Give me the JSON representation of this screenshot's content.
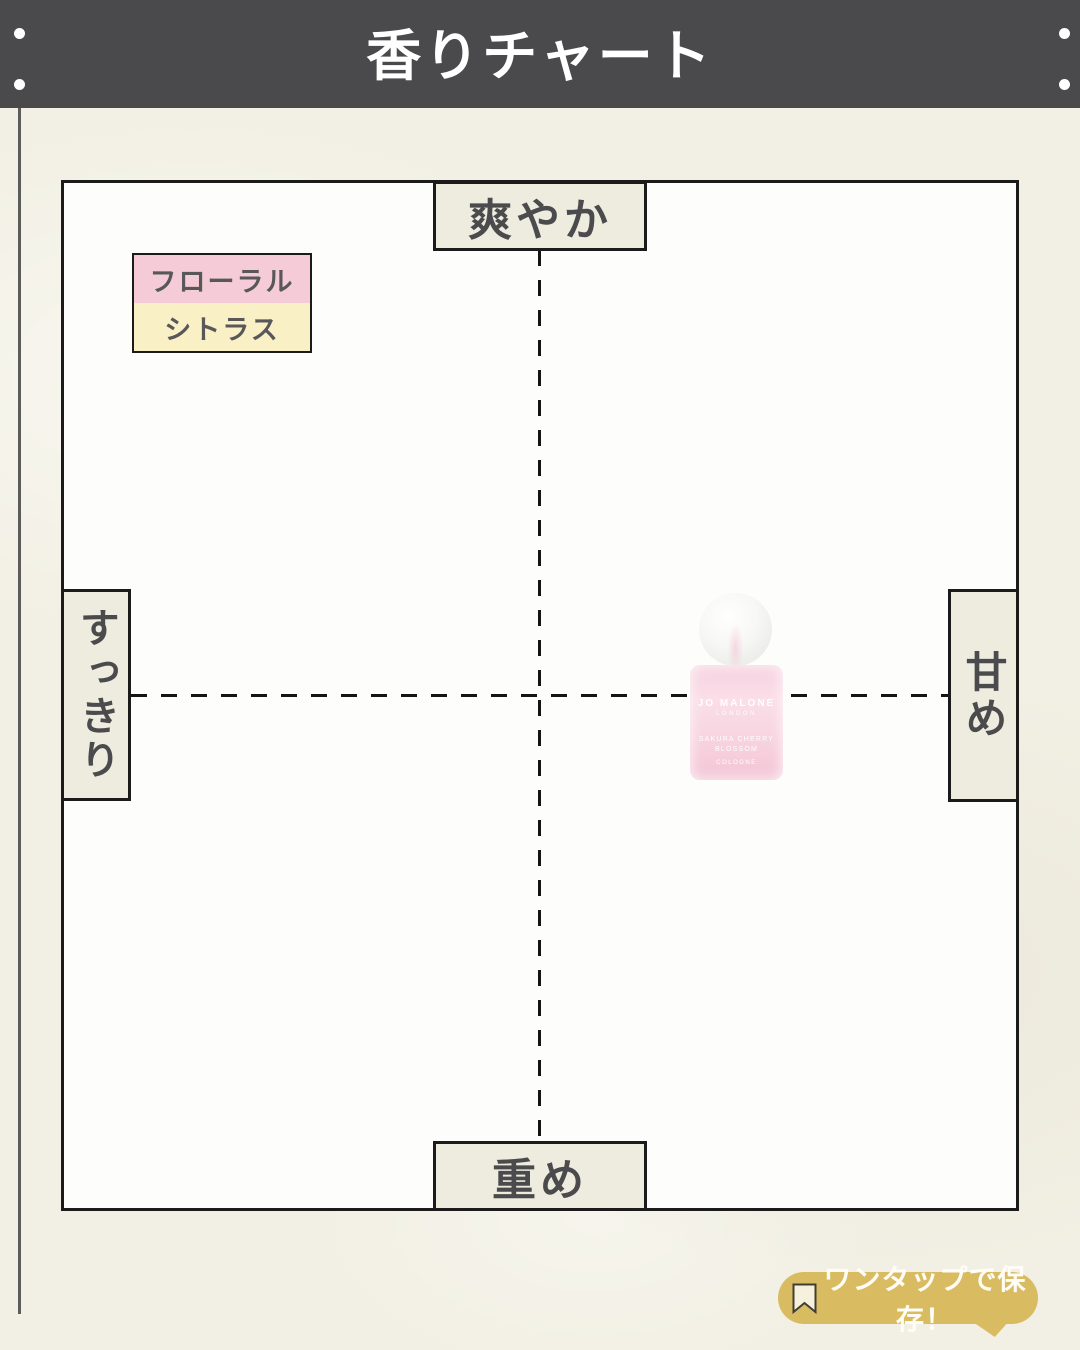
{
  "header": {
    "title": "香りチャート"
  },
  "chart": {
    "axis_labels": {
      "top": "爽やか",
      "bottom": "重め",
      "left": "すっきり",
      "right": "甘め"
    },
    "legend": {
      "items": [
        {
          "label": "フローラル",
          "color": "#f4cbd6"
        },
        {
          "label": "シトラス",
          "color": "#faf0c6"
        }
      ]
    },
    "product": {
      "brand": "JO MALONE",
      "city": "LONDON",
      "name_line1": "SAKURA CHERRY",
      "name_line2": "BLOSSOM",
      "type": "COLOGNE"
    }
  },
  "footer": {
    "save_badge": {
      "label": "ワンタップで保存！",
      "icon": "bookmark-icon",
      "color": "#d9bc62"
    }
  },
  "colors": {
    "header_bg": "#4a4a4c",
    "paper_bg": "#f2f0e4",
    "board_bg": "#fdfdfb",
    "axis_box_bg": "#edecdf",
    "border": "#1b1b1b",
    "label_text": "#4b4b4d",
    "legend_floral": "#f4cbd6",
    "legend_citrus": "#faf0c6",
    "badge_gold": "#d9bc62",
    "bottle_pink": "#f7d2e0"
  },
  "chart_data": {
    "type": "scatter",
    "title": "香りチャート",
    "x_axis": {
      "negative_label": "すっきり",
      "positive_label": "甘め",
      "range": [
        -1,
        1
      ]
    },
    "y_axis": {
      "negative_label": "重め",
      "positive_label": "爽やか",
      "range": [
        -1,
        1
      ]
    },
    "grid": "center dashed cross axes only",
    "legend": {
      "position": "top-left",
      "entries": [
        {
          "label": "フローラル",
          "color": "#f4cbd6"
        },
        {
          "label": "シトラス",
          "color": "#faf0c6"
        }
      ]
    },
    "points": [
      {
        "label": "JO MALONE LONDON SAKURA CHERRY BLOSSOM COLOGNE",
        "x": 0.41,
        "y": 0.0,
        "marker": "pink-perfume-bottle-image"
      }
    ]
  }
}
